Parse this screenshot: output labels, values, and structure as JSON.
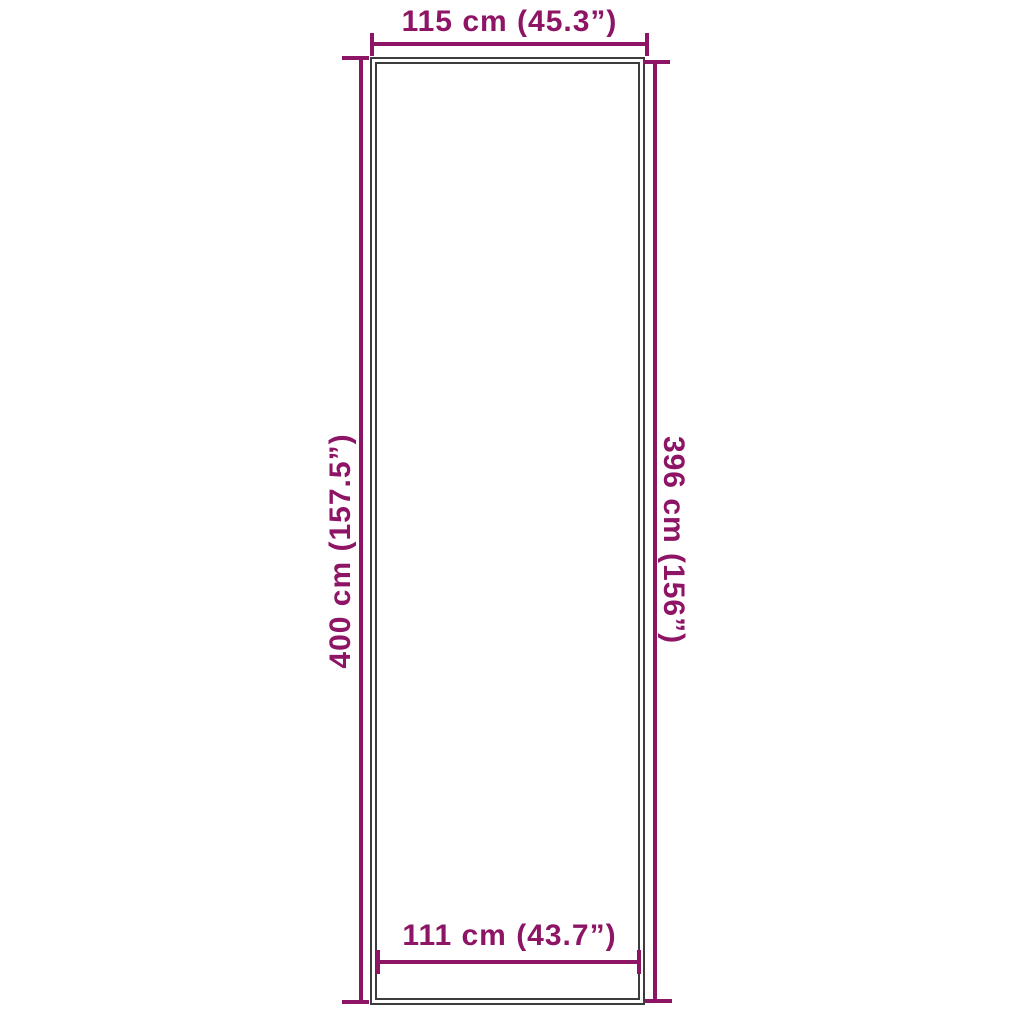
{
  "colors": {
    "dimension": "#8e1565",
    "outline": "#3c3c3c",
    "background": "#ffffff"
  },
  "diagram": {
    "type": "product-dimension-diagram",
    "shape": "tall-rectangle-double-outline",
    "dimensions": {
      "top": {
        "label": "115 cm (45.3”)"
      },
      "bottom": {
        "label": "111 cm (43.7”)"
      },
      "left": {
        "label": "400 cm (157.5”)"
      },
      "right": {
        "label": "396 cm (156”)"
      }
    }
  }
}
